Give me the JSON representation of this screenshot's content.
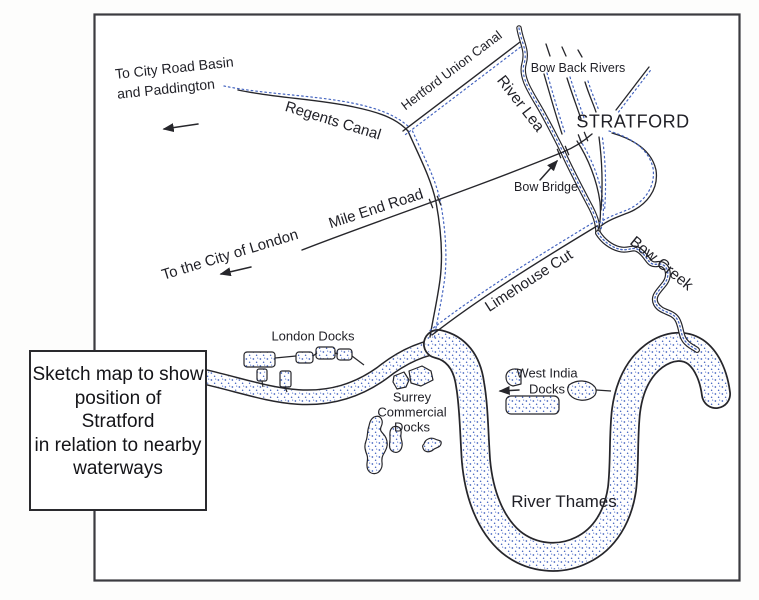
{
  "map": {
    "caption": {
      "lines": [
        "Sketch map to show",
        "position of",
        "Stratford",
        "in relation to nearby",
        "waterways"
      ]
    },
    "labels": {
      "city_road_basin": [
        "To City Road Basin",
        "and Paddington"
      ],
      "regents_canal": "Regents Canal",
      "hertford_union_canal": "Hertford Union Canal",
      "river_lea": "River Lea",
      "bow_back_rivers": "Bow Back Rivers",
      "stratford": "STRATFORD",
      "bow_bridge": "Bow Bridge",
      "mile_end_road": "Mile End Road",
      "to_city_of_london": "To the City of London",
      "limehouse_cut": "Limehouse Cut",
      "bow_creek": "Bow Creek",
      "london_docks": "London Docks",
      "surrey_commercial_docks": [
        "Surrey",
        "Commercial",
        "Docks"
      ],
      "west_india_docks": [
        "West India",
        "Docks"
      ],
      "river_thames": "River Thames"
    },
    "colors": {
      "ink": "#26262b",
      "water_stipple_blue": "#4565c0",
      "map_border": "#3b3b40",
      "paper": "#ffffff"
    }
  }
}
